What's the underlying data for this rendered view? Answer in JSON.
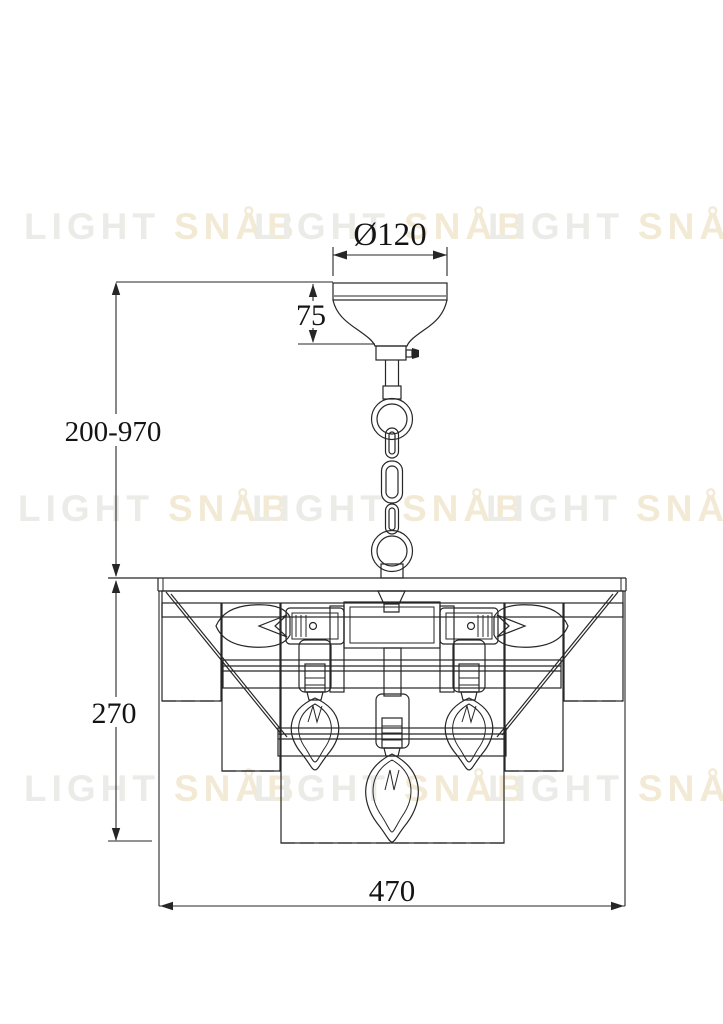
{
  "watermark": {
    "word1": "LIGHT",
    "word2": "SNÅB"
  },
  "dimensions": {
    "canopy_diameter": "Ø120",
    "canopy_height": "75",
    "hanging_height": "200-970",
    "body_height": "270",
    "body_width": "470"
  },
  "colors": {
    "line": "#262626",
    "background": "#ffffff",
    "watermark_gray": "#ebebe8",
    "watermark_yellow": "#f3ead6"
  }
}
